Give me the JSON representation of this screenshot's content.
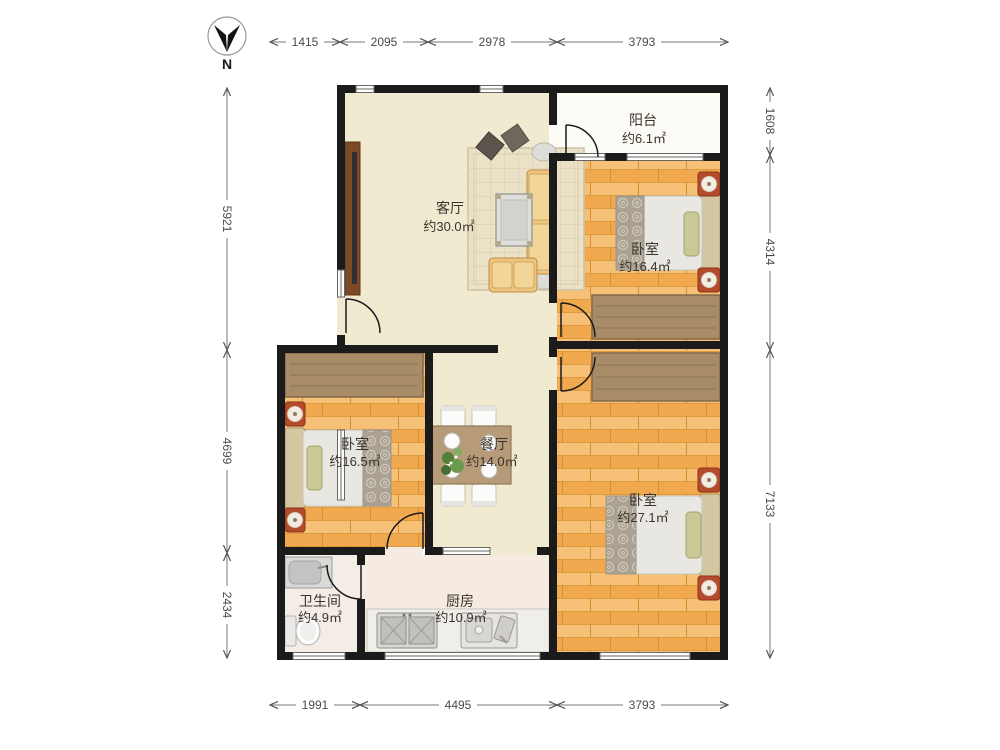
{
  "compass": {
    "north_label": "N"
  },
  "rooms": {
    "living": {
      "name": "客厅",
      "area": "约30.0㎡"
    },
    "balcony": {
      "name": "阳台",
      "area": "约6.1㎡"
    },
    "bedroom_top_right": {
      "name": "卧室",
      "area": "约16.4㎡"
    },
    "bedroom_left": {
      "name": "卧室",
      "area": "约16.5㎡"
    },
    "dining": {
      "name": "餐厅",
      "area": "约14.0㎡"
    },
    "bedroom_bottom_right": {
      "name": "卧室",
      "area": "约27.1㎡"
    },
    "bathroom": {
      "name": "卫生间",
      "area": "约4.9㎡"
    },
    "kitchen": {
      "name": "厨房",
      "area": "约10.9㎡"
    }
  },
  "dimensions": {
    "top": [
      "1415",
      "2095",
      "2978",
      "3793"
    ],
    "left": [
      "5921",
      "4699",
      "2434"
    ],
    "right": [
      "1608",
      "4314",
      "7133"
    ],
    "bottom": [
      "1991",
      "4495",
      "3793"
    ]
  },
  "colors": {
    "wall": "#1b1b1b",
    "wood_floor": "#f4b25c",
    "cream_floor": "#efead0",
    "accent_red": "#b44b2b"
  }
}
